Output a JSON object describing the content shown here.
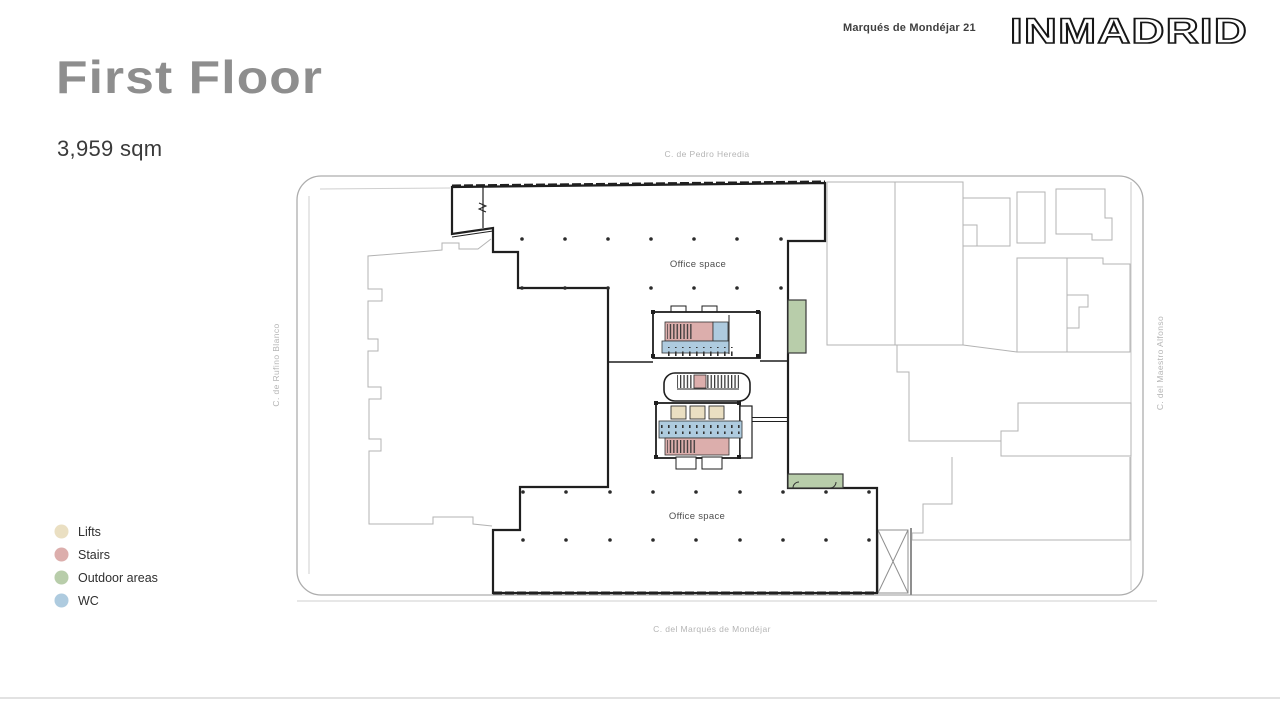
{
  "header": {
    "property_name": "Marqués de Mondéjar 21",
    "brand": "INMADRID"
  },
  "page": {
    "title": "First Floor",
    "area": "3,959 sqm"
  },
  "legend": {
    "items": [
      {
        "label": "Lifts"
      },
      {
        "label": "Stairs"
      },
      {
        "label": "Outdoor areas"
      },
      {
        "label": "WC"
      }
    ]
  },
  "colors": {
    "lifts": "#eadfc2",
    "stairs": "#dcaeac",
    "outdoor": "#b8cdaa",
    "wc": "#aecbdf",
    "walls": "#1f1f1f",
    "context": "#b3b3b3"
  },
  "plan": {
    "streets": {
      "top": "C. de Pedro Heredia",
      "bottom": "C. del Marqués de Mondéjar",
      "left": "C. de Rufino Blanco",
      "right": "C. del Maestro Alfonso"
    },
    "zones": {
      "office_top": "Office space",
      "office_bottom": "Office space"
    }
  }
}
